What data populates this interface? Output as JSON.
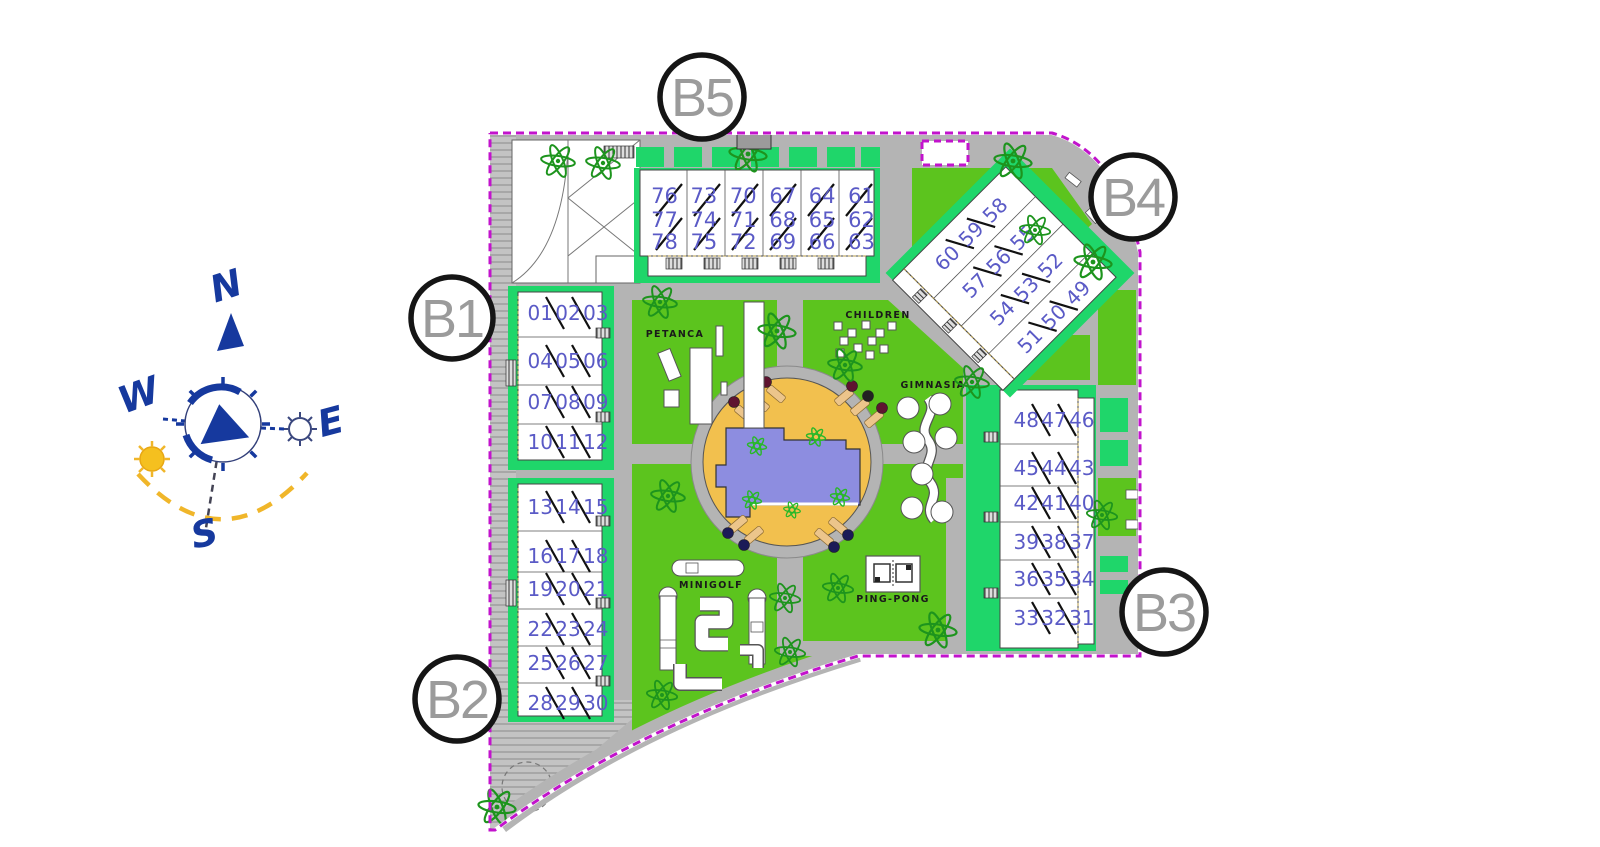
{
  "compass": {
    "north": "N",
    "south": "S",
    "east": "E",
    "west": "W"
  },
  "block_labels": {
    "b1": "B1",
    "b2": "B2",
    "b3": "B3",
    "b4": "B4",
    "b5": "B5"
  },
  "amenity_labels": {
    "petanca": "PETANCA",
    "children": "CHILDREN",
    "gimnasia": "GIMNASIA",
    "minigolf": "MINIGOLF",
    "pingpong": "PING-PONG"
  },
  "buildings": {
    "b5": {
      "name": "B5",
      "rows": [
        "76 73 70 67 64 61",
        "77 74 71 68 65 62",
        "78 75 72 69 66 63"
      ]
    },
    "b4": {
      "name": "B4",
      "rows": [
        "60 59 58",
        "57 56 55",
        "54 53 52",
        "51 50 49"
      ]
    },
    "b1": {
      "name": "B1",
      "rows": [
        "01 02 03",
        "04 05 06",
        "07 08 09",
        "10 11 12"
      ]
    },
    "b2": {
      "name": "B2",
      "rows": [
        "13 14 15",
        "16 17 18",
        "19 20 21",
        "22 23 24",
        "25 26 27",
        "28 29 30"
      ]
    },
    "b3": {
      "name": "B3",
      "rows": [
        "48 47 46",
        "45 44 43",
        "42 41 40",
        "39 38 37",
        "36 35 34",
        "33 32 31"
      ]
    }
  },
  "colors": {
    "boundary": "#c213cc",
    "lawn": "#5cc41e",
    "building_green": "#1fd66a",
    "road": "#b4b4b4",
    "pool_deck": "#f2c04e",
    "pool_water": "#8d8de0",
    "unit_number": "#5a5ac6",
    "compass_blue": "#16399e",
    "sun_yellow": "#f5c01f",
    "tree_green": "#1d941d"
  }
}
